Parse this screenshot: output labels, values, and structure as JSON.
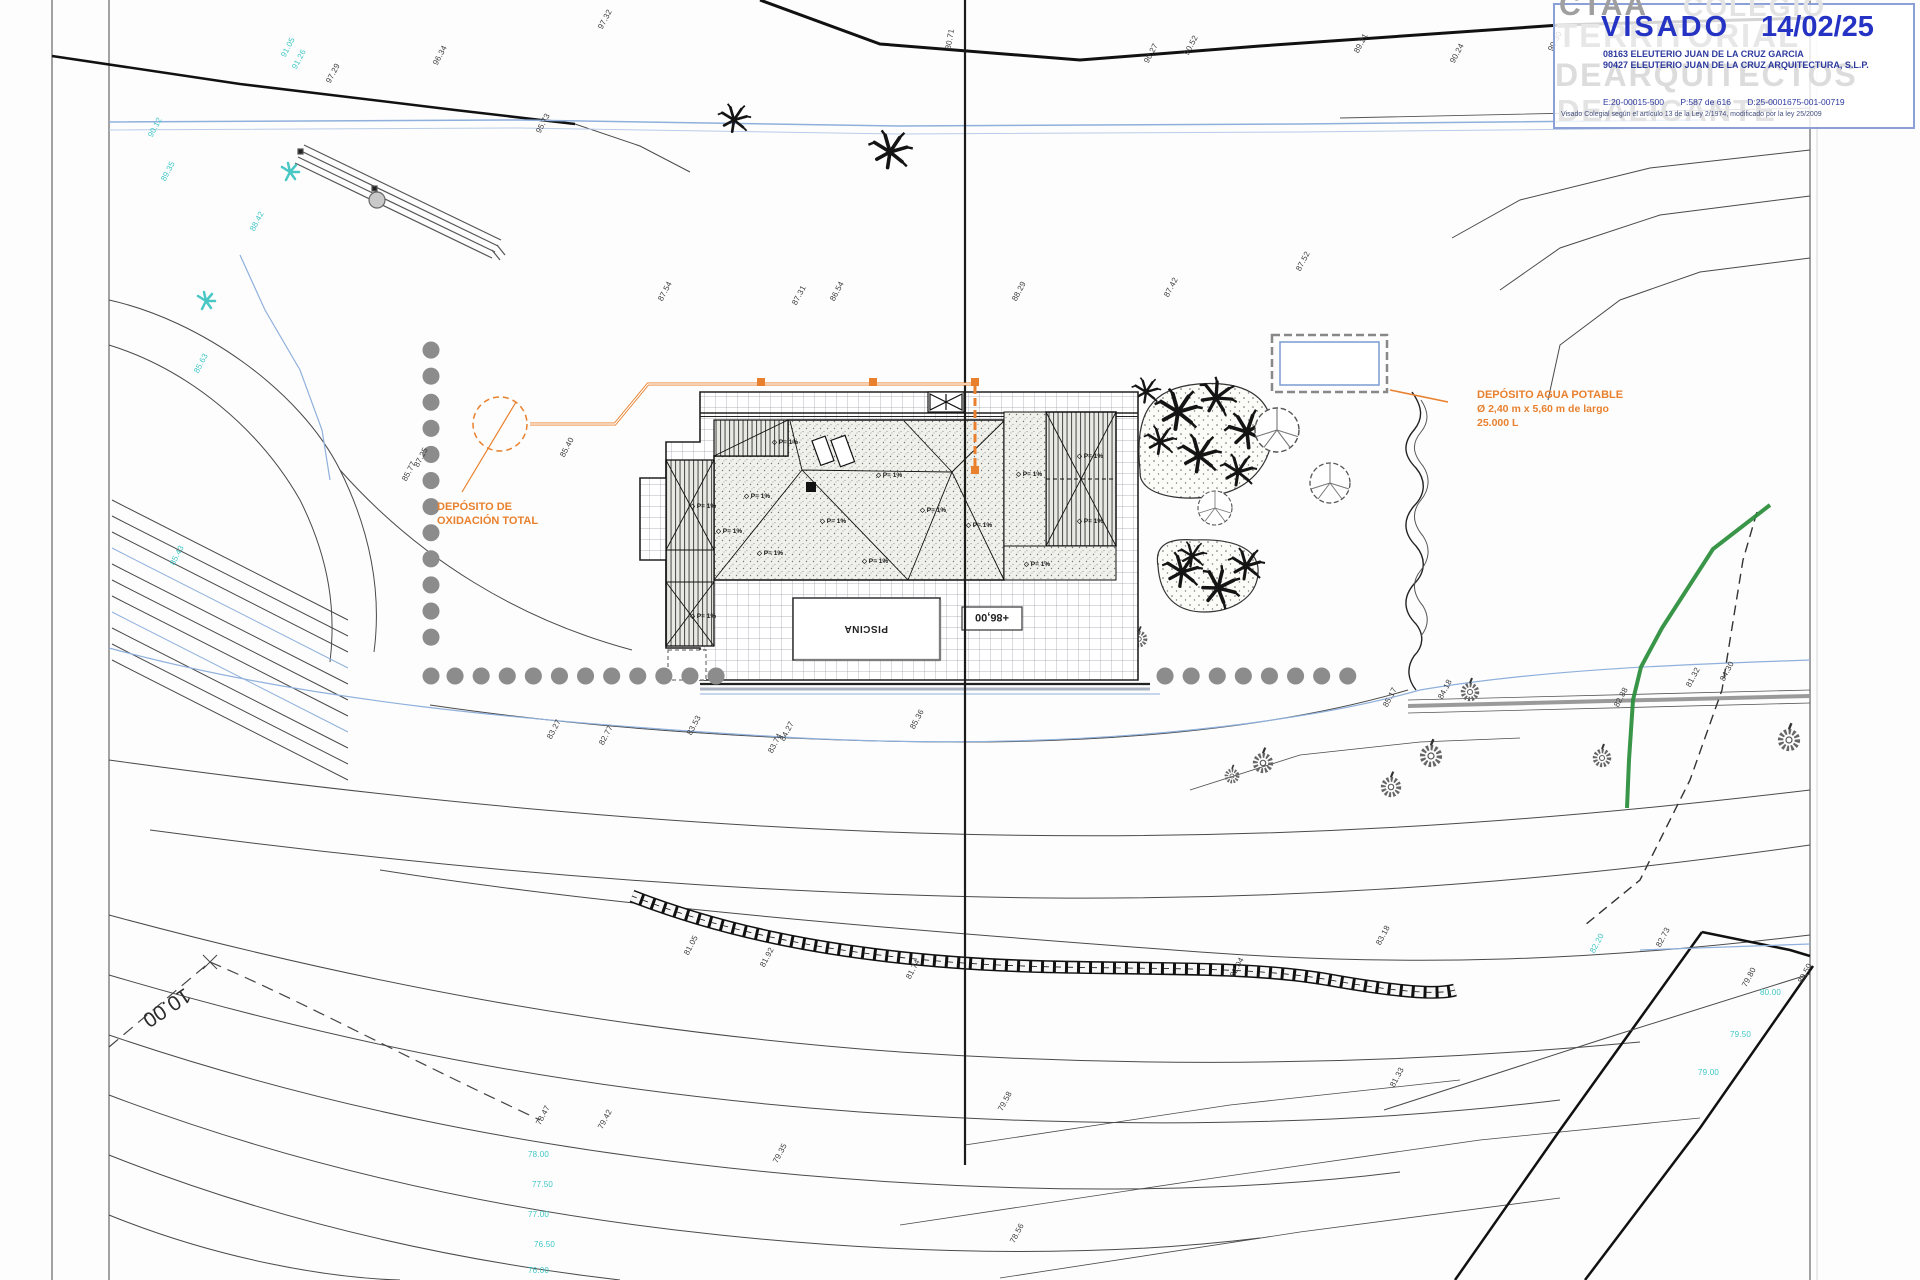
{
  "stamp": {
    "watermark_ctaa": "CTAA",
    "watermark_colegio": "COLEGIO",
    "watermark_territorial": "TERRITORIAL",
    "watermark_arquitectos": "DEARQUITECTOS",
    "watermark_alicante": "DEALICANTE",
    "visado": "VISADO",
    "date": "14/02/25",
    "line1": "08163 ELEUTERIO JUAN DE LA CRUZ GARCIA",
    "line2": "90427 ELEUTERIO JUAN DE LA CRUZ ARQUITECTURA, S.L.P.",
    "code_e": "E:20-00015-500",
    "code_p": "P:587 de 616",
    "code_d": "D:25-0001675-001-00719",
    "footnote": "Visado Colegial según el artículo 13 de la Ley 2/1974, modificado por la ley 25/2009"
  },
  "annotations": {
    "oxidation_tank_l1": "DEPÓSITO DE",
    "oxidation_tank_l2": "OXIDACIÓN TOTAL",
    "water_tank_l1": "DEPÓSITO AGUA POTABLE",
    "water_tank_l2": "Ø 2,40 m x 5,60 m de largo",
    "water_tank_l3": "25.000 L",
    "pool": "PISCINA",
    "terrace_level": "+86,00",
    "dimension": "10.00",
    "slope_label": "P= 1%",
    "slope_glyph": "◇"
  },
  "colors": {
    "accent_orange": "#e8802d",
    "stamp_blue": "#2533c4",
    "stamp_navy": "#2d3a9e",
    "cyan_label": "#3fc6c6",
    "water_blue": "#8fb0dc",
    "veg_green": "#2e8f3e",
    "hedge_dot_gray": "#8c8c8c"
  },
  "spot_elevations": [
    {
      "t": "97.29",
      "x": 328,
      "y": 78
    },
    {
      "t": "96.34",
      "x": 435,
      "y": 60
    },
    {
      "t": "95.73",
      "x": 538,
      "y": 128
    },
    {
      "t": "97.32",
      "x": 600,
      "y": 24
    },
    {
      "t": "90.12",
      "x": 150,
      "y": 132,
      "c": "c"
    },
    {
      "t": "89.35",
      "x": 163,
      "y": 176,
      "c": "c"
    },
    {
      "t": "91.05",
      "x": 283,
      "y": 52,
      "c": "c"
    },
    {
      "t": "91.26",
      "x": 294,
      "y": 64,
      "c": "c"
    },
    {
      "t": "88.42",
      "x": 252,
      "y": 226,
      "c": "c"
    },
    {
      "t": "90.27",
      "x": 1146,
      "y": 58
    },
    {
      "t": "90.52",
      "x": 1186,
      "y": 50
    },
    {
      "t": "89.21",
      "x": 1356,
      "y": 48
    },
    {
      "t": "90.24",
      "x": 1452,
      "y": 58
    },
    {
      "t": "90.30",
      "x": 1550,
      "y": 46
    },
    {
      "t": "80.71",
      "x": 948,
      "y": 45,
      "r": -80
    },
    {
      "t": "87.54",
      "x": 660,
      "y": 296
    },
    {
      "t": "87.31",
      "x": 794,
      "y": 300
    },
    {
      "t": "86.54",
      "x": 832,
      "y": 296
    },
    {
      "t": "88.29",
      "x": 1014,
      "y": 296
    },
    {
      "t": "87.42",
      "x": 1166,
      "y": 292
    },
    {
      "t": "87.52",
      "x": 1298,
      "y": 266
    },
    {
      "t": "85.77",
      "x": 404,
      "y": 476
    },
    {
      "t": "87.25",
      "x": 416,
      "y": 462
    },
    {
      "t": "85.40",
      "x": 562,
      "y": 452
    },
    {
      "t": "85.63",
      "x": 196,
      "y": 368,
      "c": "c"
    },
    {
      "t": "85.43",
      "x": 172,
      "y": 560,
      "c": "c"
    },
    {
      "t": "83.27",
      "x": 549,
      "y": 734
    },
    {
      "t": "82.77",
      "x": 601,
      "y": 740
    },
    {
      "t": "83.53",
      "x": 689,
      "y": 730
    },
    {
      "t": "83.74",
      "x": 770,
      "y": 748
    },
    {
      "t": "84.27",
      "x": 782,
      "y": 736
    },
    {
      "t": "85.36",
      "x": 912,
      "y": 724
    },
    {
      "t": "85.17",
      "x": 1385,
      "y": 702
    },
    {
      "t": "84.18",
      "x": 1440,
      "y": 694
    },
    {
      "t": "81.32",
      "x": 1688,
      "y": 682
    },
    {
      "t": "84.30",
      "x": 1722,
      "y": 676
    },
    {
      "t": "82.88",
      "x": 1616,
      "y": 702
    },
    {
      "t": "81.05",
      "x": 686,
      "y": 950
    },
    {
      "t": "81.92",
      "x": 762,
      "y": 962
    },
    {
      "t": "81.74",
      "x": 908,
      "y": 974
    },
    {
      "t": "82.04",
      "x": 1232,
      "y": 972
    },
    {
      "t": "83.18",
      "x": 1378,
      "y": 940
    },
    {
      "t": "82.20",
      "x": 1592,
      "y": 948,
      "c": "c"
    },
    {
      "t": "82.73",
      "x": 1658,
      "y": 942
    },
    {
      "t": "81.33",
      "x": 1392,
      "y": 1082
    },
    {
      "t": "79.58",
      "x": 1000,
      "y": 1106
    },
    {
      "t": "79.42",
      "x": 600,
      "y": 1124
    },
    {
      "t": "78.47",
      "x": 538,
      "y": 1120
    },
    {
      "t": "79.35",
      "x": 775,
      "y": 1158
    },
    {
      "t": "78.56",
      "x": 1012,
      "y": 1238
    },
    {
      "t": "79.80",
      "x": 1744,
      "y": 982
    },
    {
      "t": "80.50",
      "x": 1800,
      "y": 978
    },
    {
      "t": "80.00",
      "x": 1760,
      "y": 988,
      "c": "c",
      "r": 0
    },
    {
      "t": "79.50",
      "x": 1730,
      "y": 1030,
      "c": "c",
      "r": 0
    },
    {
      "t": "79.00",
      "x": 1698,
      "y": 1068,
      "c": "c",
      "r": 0
    },
    {
      "t": "78.00",
      "x": 528,
      "y": 1150,
      "c": "c",
      "r": 0
    },
    {
      "t": "77.50",
      "x": 532,
      "y": 1180,
      "c": "c",
      "r": 0
    },
    {
      "t": "77.00",
      "x": 528,
      "y": 1210,
      "c": "c",
      "r": 0
    },
    {
      "t": "76.50",
      "x": 534,
      "y": 1240,
      "c": "c",
      "r": 0
    },
    {
      "t": "76.00",
      "x": 528,
      "y": 1266,
      "c": "c",
      "r": 0
    }
  ],
  "slope_markers": [
    {
      "x": 772,
      "y": 438
    },
    {
      "x": 744,
      "y": 492
    },
    {
      "x": 716,
      "y": 527
    },
    {
      "x": 690,
      "y": 502
    },
    {
      "x": 690,
      "y": 612
    },
    {
      "x": 757,
      "y": 549
    },
    {
      "x": 820,
      "y": 517
    },
    {
      "x": 876,
      "y": 471
    },
    {
      "x": 920,
      "y": 506
    },
    {
      "x": 966,
      "y": 521
    },
    {
      "x": 1016,
      "y": 470
    },
    {
      "x": 1077,
      "y": 452
    },
    {
      "x": 1077,
      "y": 517
    },
    {
      "x": 862,
      "y": 557
    },
    {
      "x": 1024,
      "y": 560
    }
  ]
}
